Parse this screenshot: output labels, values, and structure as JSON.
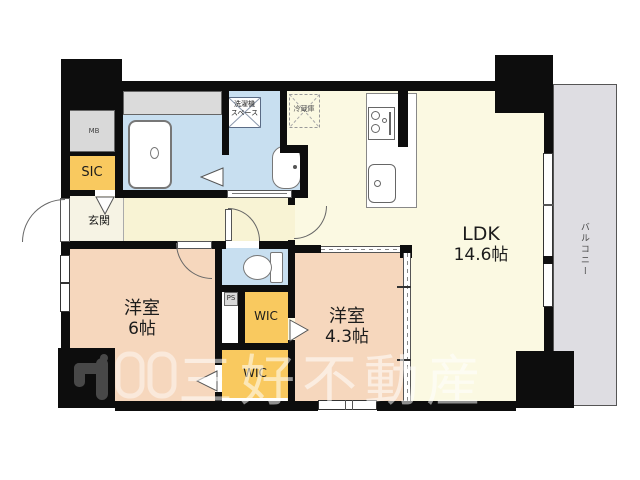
{
  "rooms": {
    "ldk": {
      "name": "LDK",
      "size": "14.6帖"
    },
    "bedroom6": {
      "name": "洋室",
      "size": "6帖"
    },
    "bedroom43": {
      "name": "洋室",
      "size": "4.3帖"
    },
    "genkan": {
      "name": "玄関"
    },
    "sic": {
      "name": "SIC"
    },
    "mb": {
      "name": "MB"
    },
    "ps": {
      "name": "PS"
    },
    "wic_upper": {
      "name": "WIC"
    },
    "wic_lower": {
      "name": "WIC"
    },
    "balcony": {
      "name": "バルコニー"
    },
    "laundry": {
      "line1": "洗濯機",
      "line2": "スペース"
    },
    "fridge": {
      "name": "冷蔵庫"
    }
  },
  "watermark": {
    "text": "三好不動産"
  },
  "colors": {
    "wall": "#0d0d0d",
    "room_pink": "#f6d7bd",
    "ldk_cream": "#fbf9e2",
    "hall_cream": "#f8f3d4",
    "genkan_cream": "#f6f3e4",
    "wet_blue": "#c8dff0",
    "closet_yellow": "#f9c95f",
    "gray_box": "#d9d9d9",
    "balcony_gray": "#dedde2"
  }
}
